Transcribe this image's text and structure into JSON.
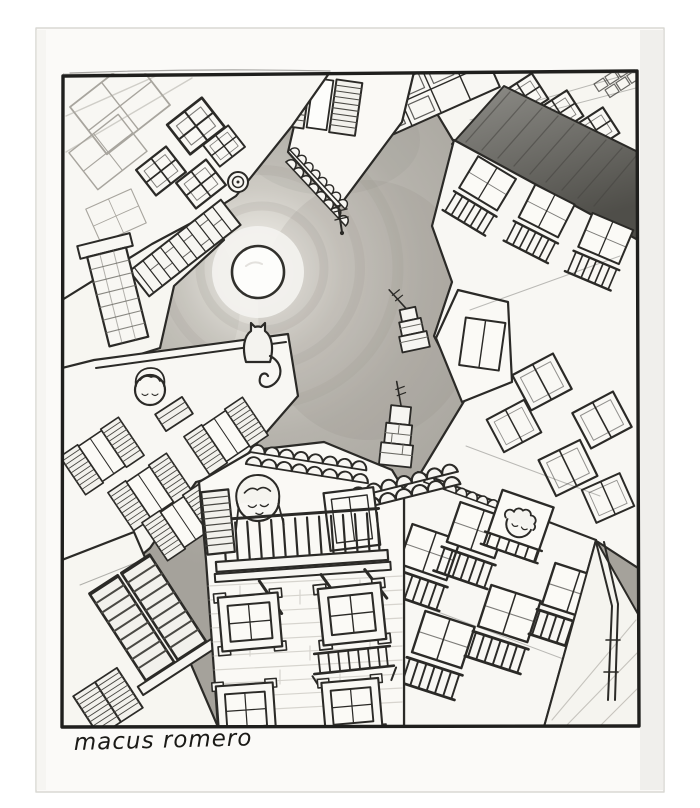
{
  "artwork": {
    "signature": "macus romero",
    "scene_description": "Hand-drawn pencil illustration: worm's-eye (looking straight up) view from a narrow courtyard, tilted old buildings with shuttered windows and balconies converging on a patch of sky with a full moon; a cat sits on a roof ridge and small figures look out of windows and a wooden balcony.",
    "elements": [
      "full-moon",
      "cat-on-roof-ridge",
      "girl-on-wooden-balcony",
      "woman-at-left-window",
      "person-at-right-window",
      "tv-antenna",
      "rooftop-towers",
      "louvered-shutters",
      "balcony-railings",
      "roof-tiles",
      "brick-chimney",
      "dark-shaded-roof-band",
      "stone-framed-windows",
      "drawn-rectangular-frame",
      "paper-sheet"
    ],
    "palette": {
      "background": "#ffffff",
      "paper": "#fbfaf8",
      "line": "#2b2a27",
      "sky_mid": "#b6b3ac",
      "sky_glow": "#f2f1ed",
      "moon": "#fdfdfb",
      "roof_shadow": "#4f4e49"
    }
  }
}
